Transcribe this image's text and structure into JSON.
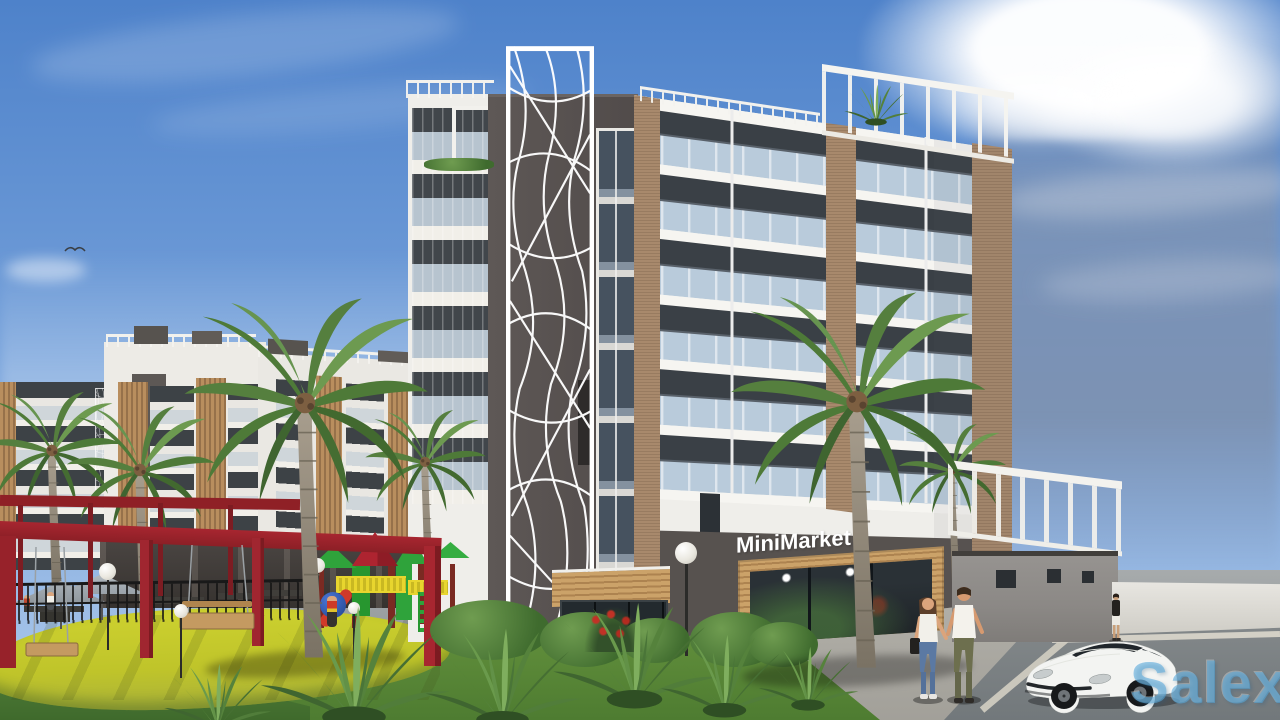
{
  "meta": {
    "type": "architectural-3d-render",
    "description": "Exterior render of a modern six-storey residential building with a ground-floor MiniMarket, playground with red pergola and swings, palm trees, pedestrians and a white sports car",
    "width_px": 1280,
    "height_px": 720
  },
  "signs": {
    "storefront": "MiniMarket"
  },
  "watermark": {
    "text": "Salexy",
    "color": "#58a8da"
  },
  "palette": {
    "sky_blue": "#4e82ca",
    "sky_right_gray": "#75839d",
    "cloud_white": "#f4f7fb",
    "facade_white": "#f0efeb",
    "facade_dark_core": "#575052",
    "window_glass_dark": "#3a4046",
    "balcony_glass": "#b9cbdb",
    "brick_column": "#a8896c",
    "wood_slats": "#c49a5f",
    "ground_floor_dark": "#57524f",
    "annex_gray": "#8f8c89",
    "boundary_wall": "#e0ded8",
    "pergola_red": "#9e2328",
    "playground_rubber_yellow": "#c9cc2e",
    "lawn_green": "#5f8c3a",
    "palm_green": "#557f3e",
    "palm_trunk": "#978d7d",
    "pavement": "#9aa0a2",
    "road": "#7e8486",
    "car_body": "#f3f4f2"
  },
  "scene_objects": [
    "sky-with-clouds",
    "bird",
    "background-apartment-blocks",
    "white-lattice-screens",
    "main-building",
    "decorative-lattice-tower",
    "stairwell-glass-strip",
    "balconies-with-glass-railings",
    "brick-accent-columns",
    "rooftop-pergola",
    "minimarket-storefront",
    "entrance-canopy",
    "service-annex-with-pergola",
    "boundary-wall",
    "red-pergola-with-swings",
    "playground-structure",
    "picnic-umbrellas",
    "metal-fence",
    "street-lamps",
    "palm-trees",
    "agave-plants",
    "lawn",
    "rubber-playground-surface",
    "paved-plaza",
    "road",
    "walking-couple",
    "distant-pedestrian",
    "playground-child",
    "white-sports-car"
  ]
}
